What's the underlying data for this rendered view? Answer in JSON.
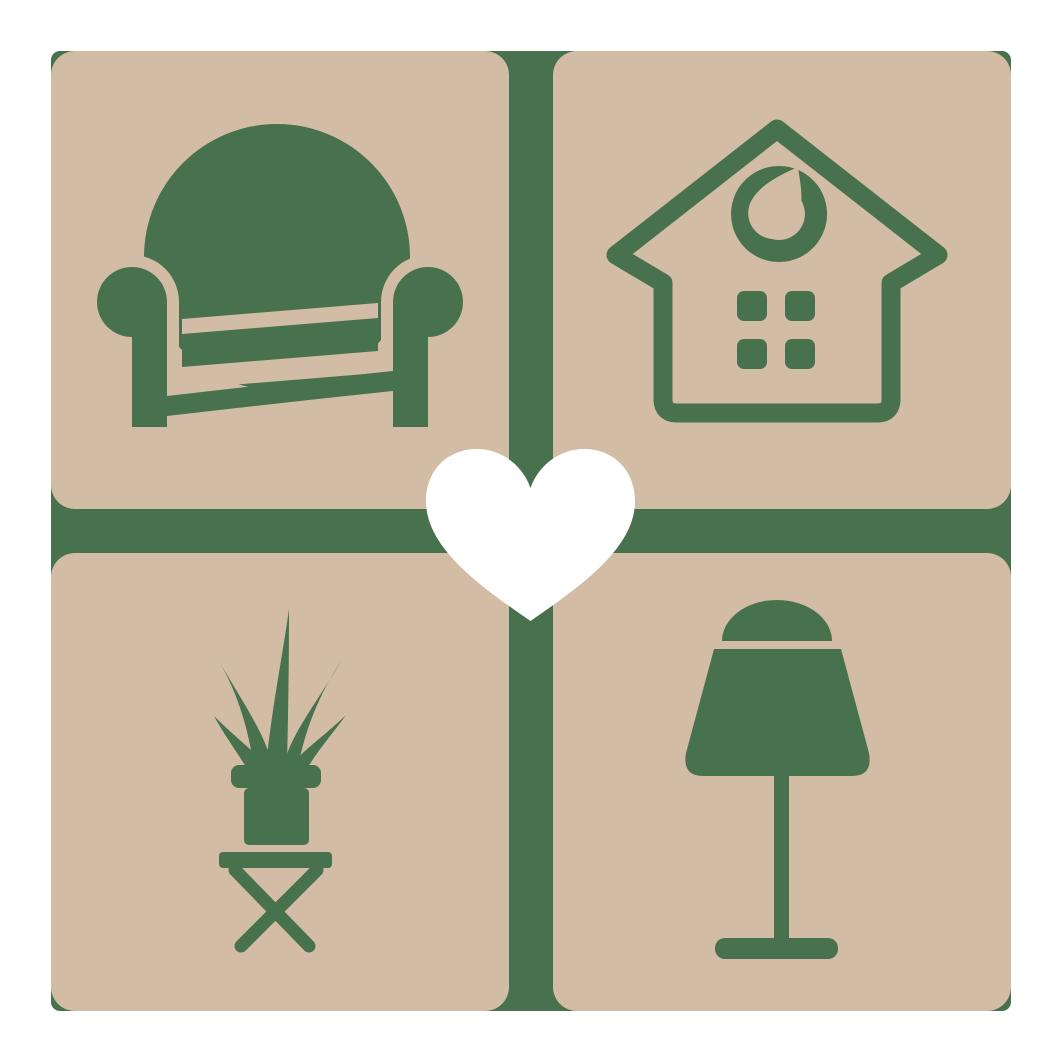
{
  "page": {
    "background": "#ffffff"
  },
  "logo": {
    "name": "home-furniture-favorites-logo",
    "colors": {
      "tile": "#d3bca5",
      "icon": "#48724d",
      "gutter": "#48724d",
      "heart": "#ffffff",
      "background": "#ffffff"
    },
    "grid": {
      "rows": 2,
      "columns": 2
    },
    "tiles": [
      {
        "position": "top-left",
        "icon": "armchair-icon"
      },
      {
        "position": "top-right",
        "icon": "house-icon"
      },
      {
        "position": "bottom-left",
        "icon": "potted-plant-icon"
      },
      {
        "position": "bottom-right",
        "icon": "table-lamp-icon"
      }
    ],
    "center": {
      "icon": "heart-icon"
    }
  }
}
